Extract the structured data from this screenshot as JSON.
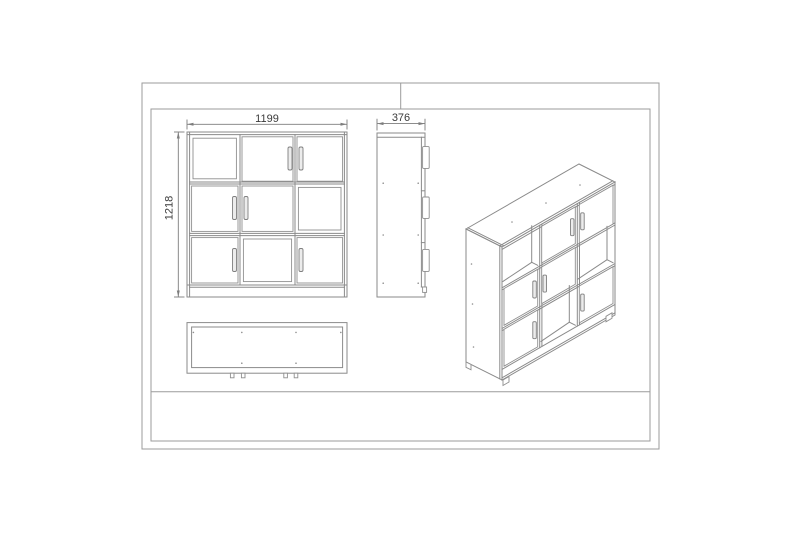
{
  "colors": {
    "background": "#ffffff",
    "frame_line": "#9b9b9b",
    "drawing_line": "#8a8a8a",
    "dimension_line": "#7d7d7d",
    "text": "#3a3a3a",
    "handle_fill": "#ececec"
  },
  "dimensions": {
    "front_width_mm": "1199",
    "front_height_mm": "1218",
    "side_depth_mm": "376"
  },
  "views": {
    "front": {
      "grid_rows": 3,
      "grid_cols": 3,
      "open_compartments": [
        "row1-col1",
        "row2-col3",
        "row3-col2"
      ],
      "door_compartments": [
        "row1-col2",
        "row1-col3",
        "row2-col1",
        "row2-col2",
        "row3-col1",
        "row3-col3"
      ]
    },
    "side": {
      "visible_door_edges": 3
    },
    "top": {
      "feet_pairs": 2
    },
    "isometric": {
      "visible_handles": 6
    }
  }
}
